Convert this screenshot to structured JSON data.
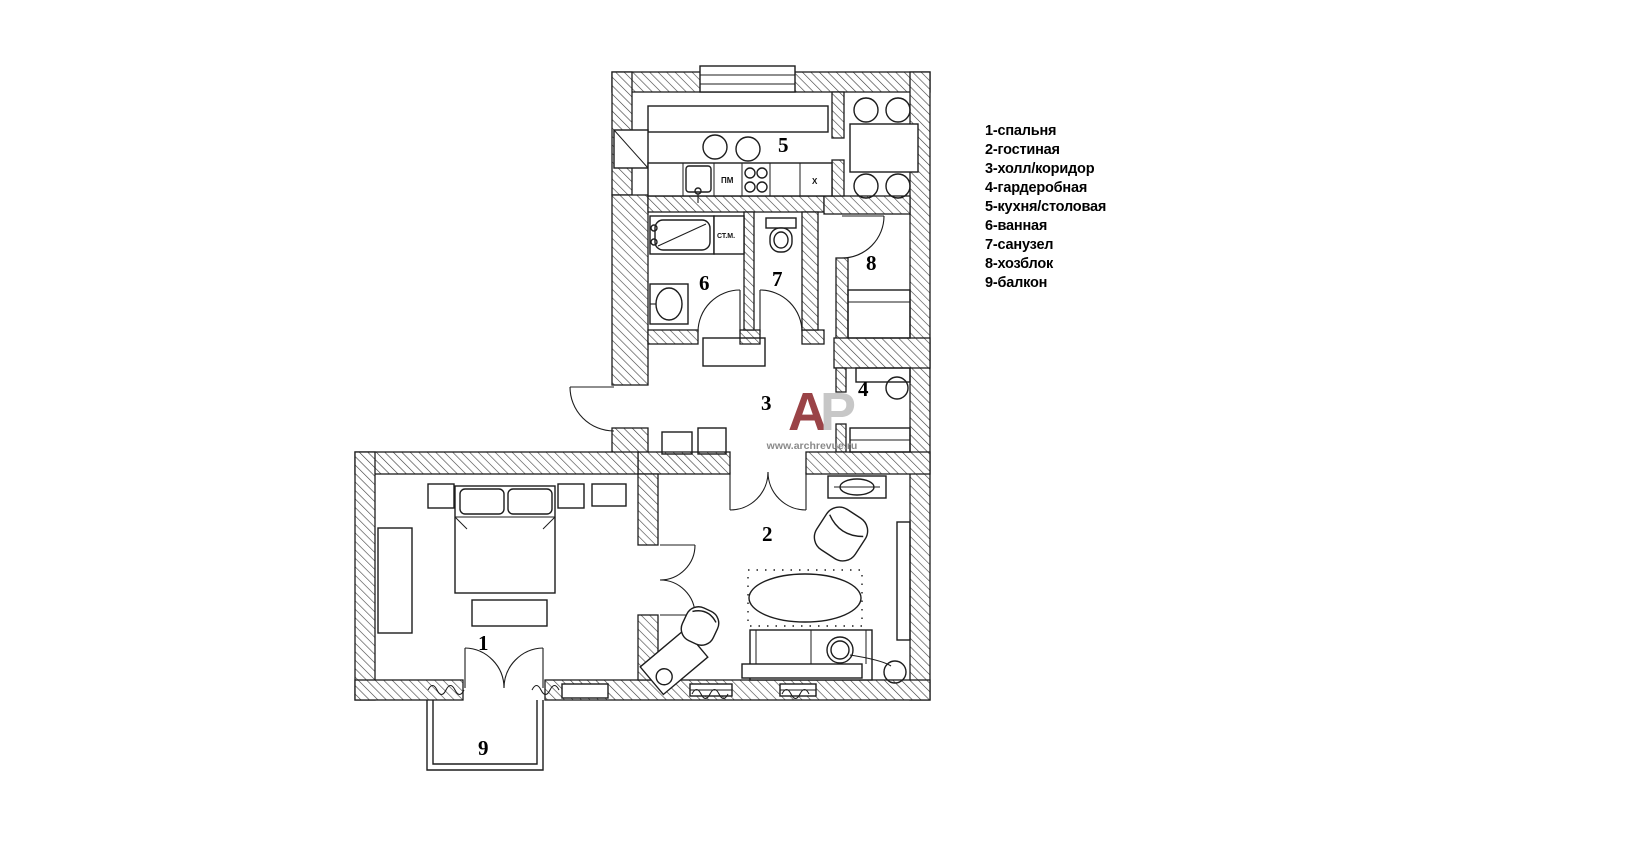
{
  "legend": {
    "items": [
      "1-спальня",
      "2-гостиная",
      "3-холл/коридор",
      "4-гардеробная",
      "5-кухня/столовая",
      "6-ванная",
      "7-санузел",
      "8-хозблок",
      "9-балкон"
    ]
  },
  "rooms": {
    "bedroom": "1",
    "living": "2",
    "hall": "3",
    "wardrobe": "4",
    "kitchen": "5",
    "bath": "6",
    "wc": "7",
    "utility": "8",
    "balcony": "9"
  },
  "fixtures": {
    "washing_machine": "СТ.М.",
    "dishwasher": "ПМ",
    "fridge": "Х"
  },
  "logo": {
    "letter_a": "А",
    "letter_p": "Р",
    "website": "www.archrevue.ru",
    "color_a": "#9a4347",
    "color_p": "#c7c7c7"
  }
}
